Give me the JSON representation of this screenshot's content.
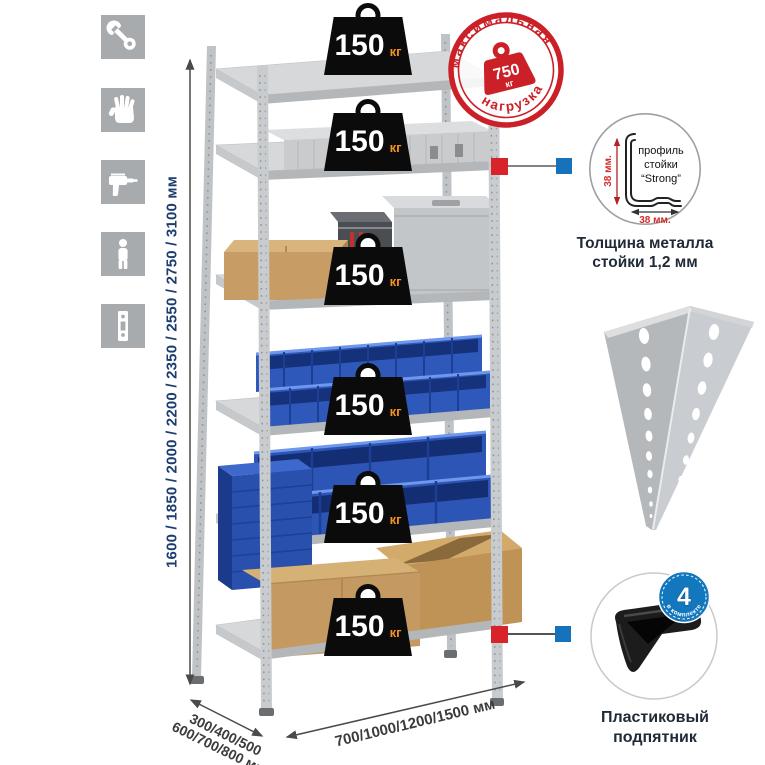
{
  "canvas": {
    "background": "#ffffff"
  },
  "assembly_icons": {
    "tile_color": "#a8abae",
    "items": [
      {
        "name": "wrench"
      },
      {
        "name": "gloves"
      },
      {
        "name": "drill"
      },
      {
        "name": "person"
      },
      {
        "name": "upright-post"
      }
    ]
  },
  "dimensions": {
    "height": "1600 / 1850 / 2000 / 2200 / 2350 / 2550 / 2750 / 3100 мм",
    "depth_line1": "300/400/500",
    "depth_line2": "600/700/800 мм",
    "width": "700/1000/1200/1500 мм"
  },
  "shelf_weights": [
    {
      "value": "150",
      "unit": "кг"
    },
    {
      "value": "150",
      "unit": "кг"
    },
    {
      "value": "150",
      "unit": "кг"
    },
    {
      "value": "150",
      "unit": "кг"
    },
    {
      "value": "150",
      "unit": "кг"
    },
    {
      "value": "150",
      "unit": "кг"
    }
  ],
  "max_load_stamp": {
    "arc_top": "максимальная",
    "arc_bottom": "нагрузка",
    "value": "750",
    "unit": "кг",
    "color": "#cb2027"
  },
  "profile_detail": {
    "caption1": "профиль",
    "caption2": "стойки",
    "caption3": "“Strong”",
    "vertical_dim": "38 мм.",
    "horizontal_dim": "38 мм.",
    "label_line1": "Толщина металла",
    "label_line2": "стойки 1,2 мм"
  },
  "foot_detail": {
    "badge_number": "4",
    "badge_arc": "в комплекте",
    "label_line1": "Пластиковый",
    "label_line2": "подпятник"
  },
  "colors": {
    "stamp_red": "#cb2027",
    "marker_red": "#d8232a",
    "marker_blue": "#1673bb",
    "badge_blue": "#1277bd",
    "weight_black": "#0b0b0b",
    "kg_orange": "#f59120",
    "dimension_navy": "#1d3d70",
    "bin_blue": "#2e59ba"
  }
}
